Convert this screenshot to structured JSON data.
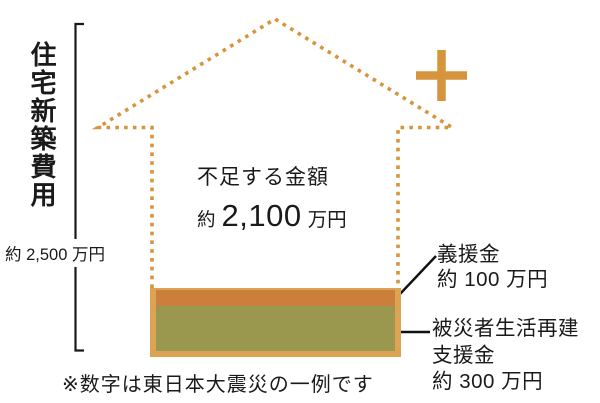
{
  "diagram": {
    "left_axis": {
      "title": "住宅新築費用",
      "total_amount": "約 2,500 万円"
    },
    "shortfall": {
      "title": "不足する金額",
      "amount_prefix": "約",
      "amount_value": "2,100",
      "amount_unit": "万円"
    },
    "funds": {
      "gienkin": {
        "label": "義援金",
        "amount": "約 100 万円"
      },
      "shienkin": {
        "label_line1": "被災者生活再建",
        "label_line2": "支援金",
        "amount": "約 300 万円"
      }
    },
    "note": "※数字は東日本大震災の一例です",
    "colors": {
      "outline_orange": "#d6953d",
      "frame_orange": "#dca353",
      "gienkin_orange": "#cc7f3d",
      "shienkin_olive": "#9a974f",
      "line_black": "#1a1a1a"
    }
  }
}
